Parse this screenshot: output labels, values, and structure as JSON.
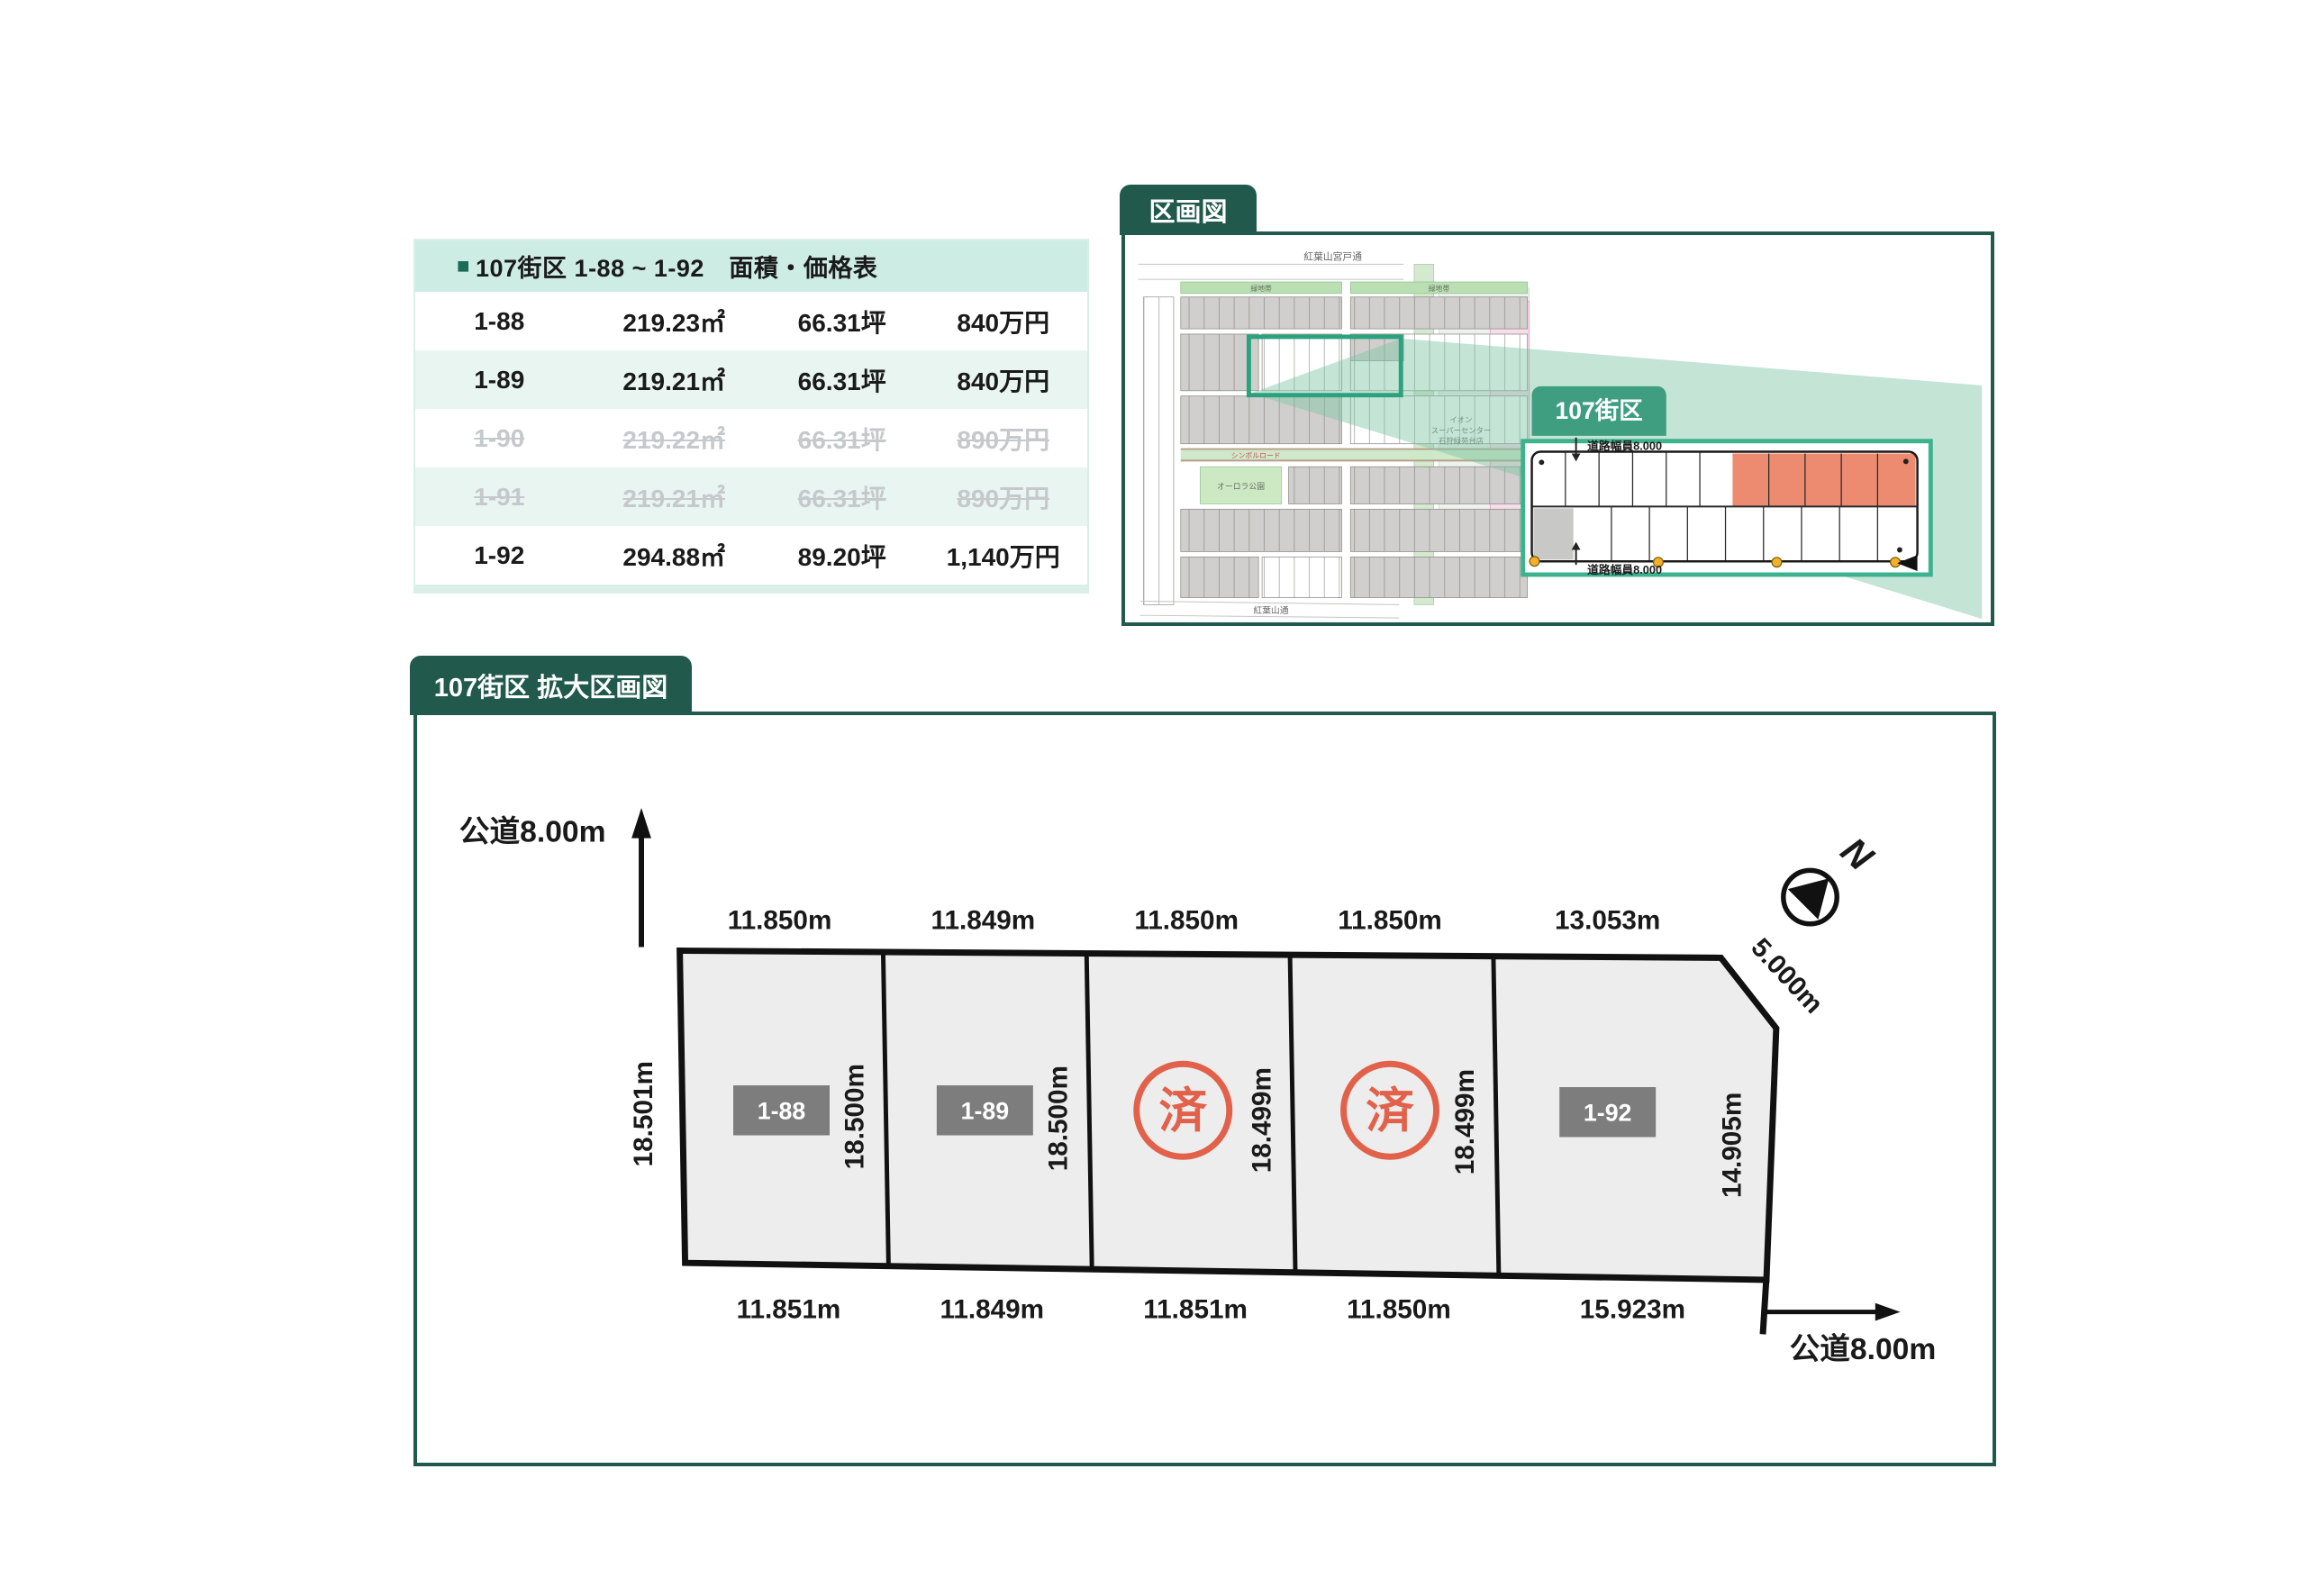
{
  "price_table": {
    "header_marker": "■",
    "header_title": "107街区 1-88 ~ 1-92　面積・価格表",
    "rows": [
      {
        "lot": "1-88",
        "area": "219.23㎡",
        "tsubo": "66.31坪",
        "price": "840万円"
      },
      {
        "lot": "1-89",
        "area": "219.21㎡",
        "tsubo": "66.31坪",
        "price": "840万円"
      },
      {
        "lot": "1-90",
        "area": "219.22㎡",
        "tsubo": "66.31坪",
        "price": "890万円"
      },
      {
        "lot": "1-91",
        "area": "219.21㎡",
        "tsubo": "66.31坪",
        "price": "890万円"
      },
      {
        "lot": "1-92",
        "area": "294.88㎡",
        "tsubo": "89.20坪",
        "price": "1,140万円"
      }
    ]
  },
  "overview": {
    "tab_label": "区画図",
    "map": {
      "road_top": "紅葉山宮戸通",
      "road_bottom": "紅葉山通",
      "green_belt_left": "緑地帯",
      "green_belt_right": "緑地帯",
      "park": "オーロラ公園",
      "symbol_road": "シンボルロード",
      "store_line1": "イオン",
      "store_line2": "スーパーセンター",
      "store_line3": "石狩緑苑台店"
    },
    "inset": {
      "label": "107街区",
      "road_width_top": "道路幅員8.000",
      "road_width_bottom": "道路幅員8.000"
    }
  },
  "plan": {
    "tab_label": "107街区 拡大区画図",
    "road_top_left": "公道8.00m",
    "road_bottom_right": "公道8.00m",
    "compass_label": "N",
    "corner_dim": "5.000m",
    "outer_left_dim": "18.501m",
    "sold_mark": "済",
    "lots": [
      {
        "id": "1-88",
        "top_dim": "11.850m",
        "bottom_dim": "11.851m",
        "side_dim": "18.500m",
        "status": "available"
      },
      {
        "id": "1-89",
        "top_dim": "11.849m",
        "bottom_dim": "11.849m",
        "side_dim": "18.500m",
        "status": "available"
      },
      {
        "id": "1-90",
        "top_dim": "11.850m",
        "bottom_dim": "11.851m",
        "side_dim": "18.499m",
        "status": "sold"
      },
      {
        "id": "1-91",
        "top_dim": "11.850m",
        "bottom_dim": "11.850m",
        "side_dim": "18.499m",
        "status": "sold"
      },
      {
        "id": "1-92",
        "top_dim": "13.053m",
        "bottom_dim": "15.923m",
        "side_dim": "14.905m",
        "status": "available"
      }
    ]
  },
  "colors": {
    "teal_dark": "#215a4c",
    "mint_header": "#cdece4",
    "mint_row": "#e8f5f1",
    "inset_border_green": "#3cb28d",
    "inset_label_green": "#3f9e80",
    "highlight_green": "#2aa27d",
    "beam_green": "#7cc3a4",
    "salmon_lot": "#ec8b6f",
    "sold_red": "#e2614a",
    "tag_gray": "#7d7d7d",
    "lot_fill": "#ededed"
  }
}
